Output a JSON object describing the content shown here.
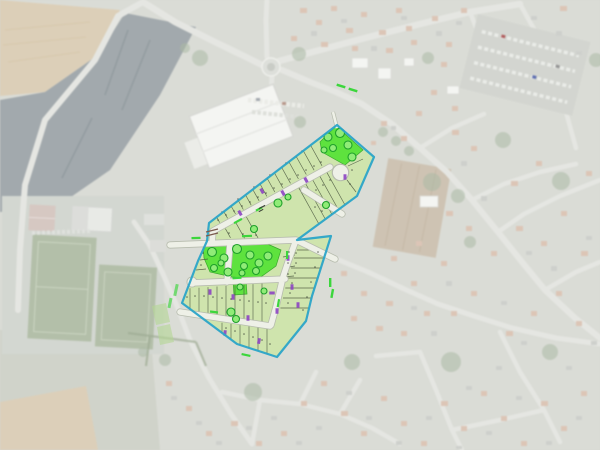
{
  "scene": {
    "type": "aerial-photograph-with-subdivision-plan-overlay",
    "description": "Washed-out aerial photo of a small town with a colored allotment (lotissement) plan overlaid in the centre",
    "canvas": {
      "width": 600,
      "height": 450
    },
    "visible_text": "none legible (tiny lot annotations only)"
  },
  "palette": {
    "base": "#d6d8d2",
    "field_tan": "#d9cab0",
    "field_dark": "#8d979c",
    "field_brown": "#c8baa6",
    "field_muted": "#c8ccc0",
    "pitch": "#abb8a0",
    "road": "#e3e4df",
    "building": "#f3f4f1",
    "roof_a": "#d9bfae",
    "roof_b": "#c9cbc7",
    "tree_photo": "#a3b29a",
    "parking": "#ced1cb",
    "parcel": "#cfe4ab",
    "parcel_line": "#47523c",
    "park": "#5ee23e",
    "tree_fill": "#90ec77",
    "tree_line": "#1fa02b",
    "plan_road": "#eef0e7",
    "plan_road_edge": "#b7bcae",
    "boundary": "#2ba4c8",
    "purple": "#8c44c2",
    "strip": "#3cd63c",
    "outside_green": "#b5d795",
    "tick": "#7a5a4e",
    "label_dark": "#3a4034"
  },
  "overlay": {
    "boundary_color": "#2ba4c8",
    "features": {
      "residential_parcels_approx": 70,
      "green_spaces": 3,
      "trees_marked_approx": 28,
      "purple_unit_markers_approx": 15,
      "cul_de_sac": true,
      "internal_roads_approx": 8,
      "green_planting_strips": true
    }
  },
  "basemap": {
    "features": [
      "large plowed tan field (top-left)",
      "dark cultivated field (left)",
      "sports complex with two football pitches and courts (left)",
      "large white warehouse building with car park (top-centre)",
      "roundabout (top-centre)",
      "supermarket car park with car rows (top-right)",
      "brown field parallelogram (right of plan)",
      "dense residential neighbourhoods (right and bottom)",
      "tan field (bottom-left corner)"
    ]
  }
}
